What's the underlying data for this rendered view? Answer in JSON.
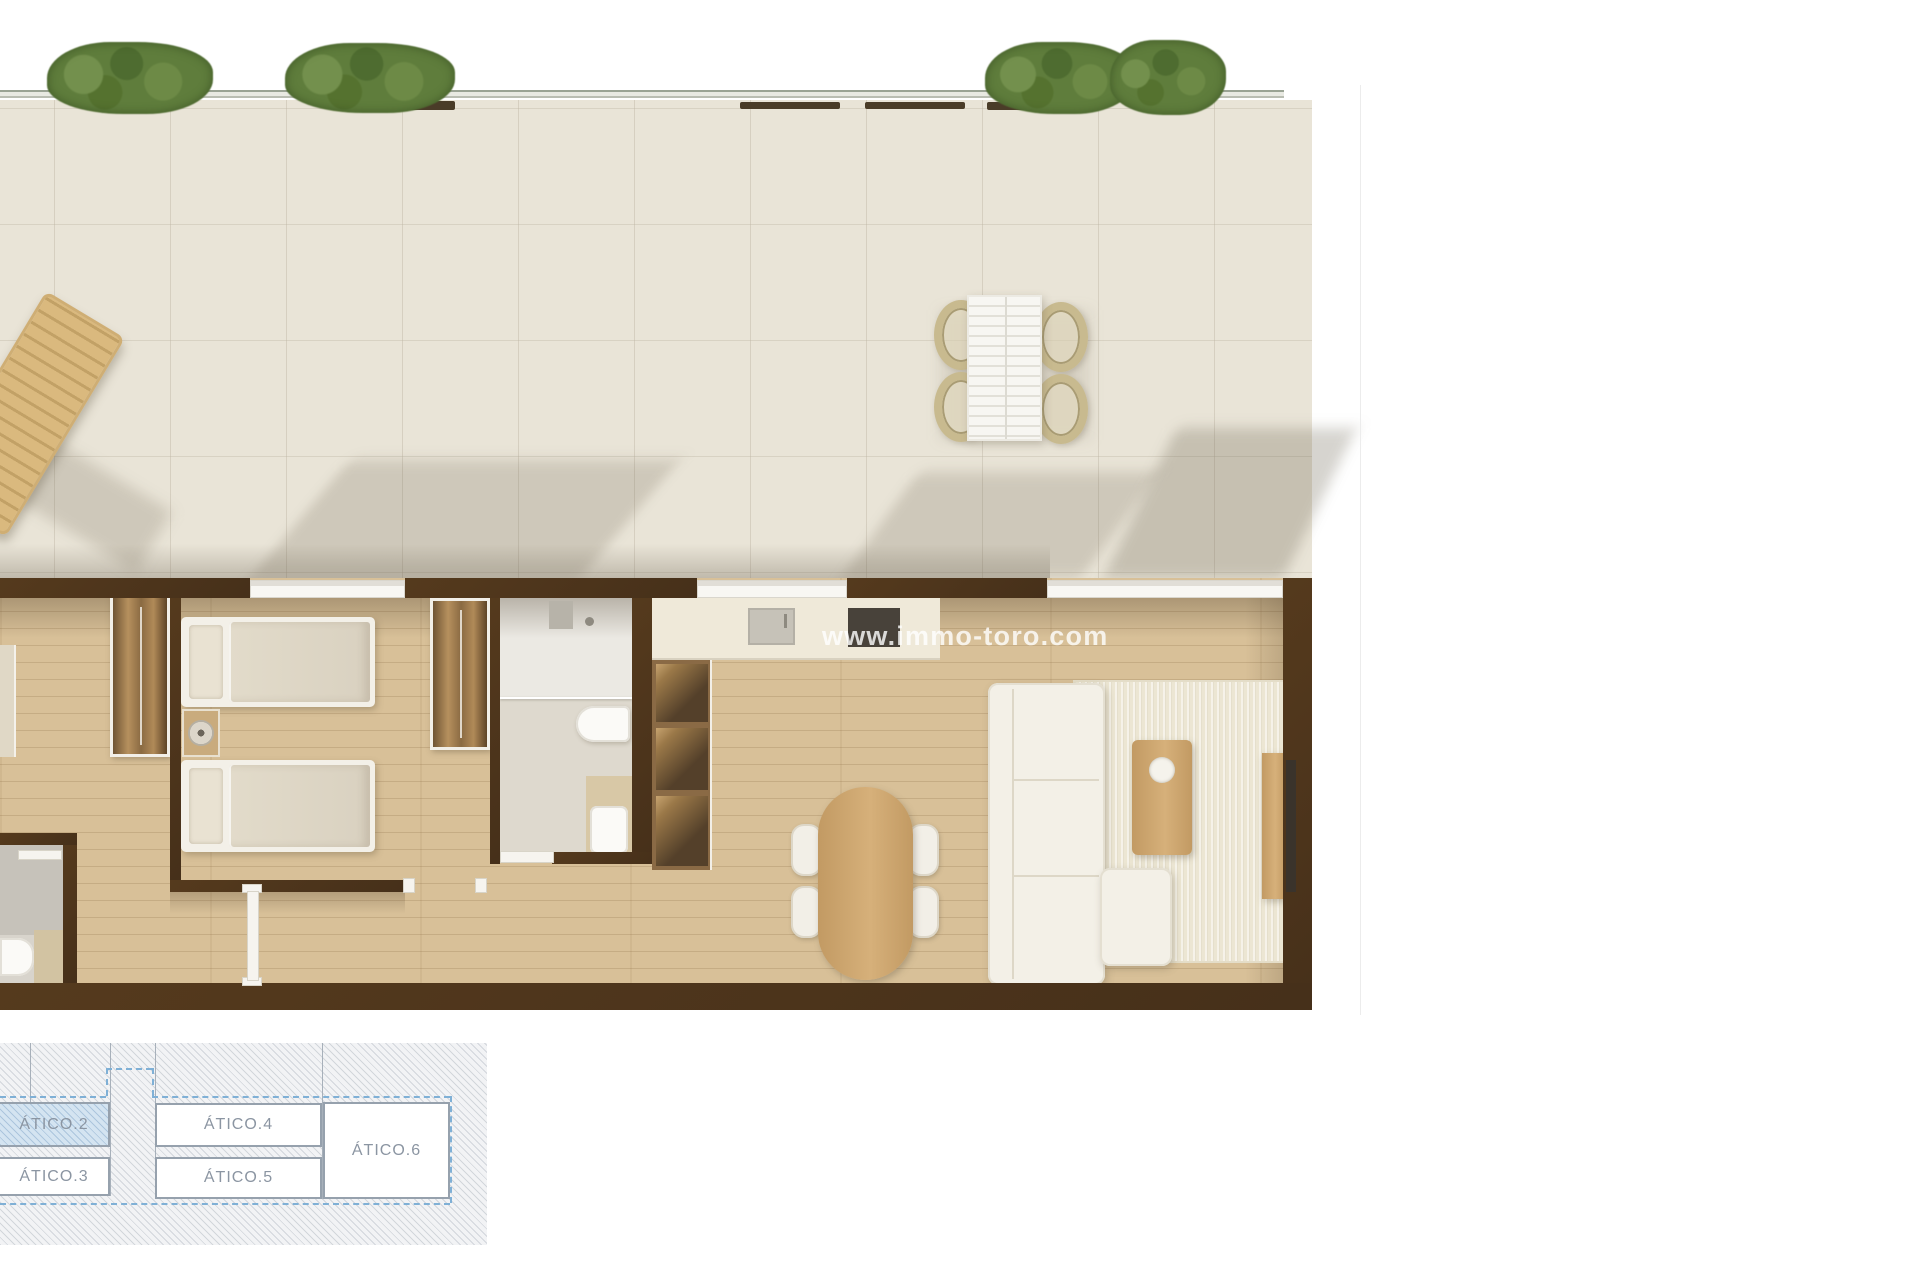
{
  "watermark": {
    "text": "www.immo-toro.com",
    "color": "#ffffff"
  },
  "keyplan": {
    "units": [
      {
        "label": "ÁTICO.2",
        "highlighted": true
      },
      {
        "label": "ÁTICO.3",
        "highlighted": false
      },
      {
        "label": "ÁTICO.4",
        "highlighted": false
      },
      {
        "label": "ÁTICO.5",
        "highlighted": false
      },
      {
        "label": "ÁTICO.6",
        "highlighted": false
      }
    ],
    "label_color": "#8b95a2",
    "highlight_fill": "#d4e4f1",
    "dash_color": "#7fb0d6"
  },
  "palette": {
    "wall": "#4d3419",
    "wood_floor": "#d8c098",
    "terrace_tile": "#e9e4d7",
    "hedge_green": "#5f7d3c",
    "rug": "#ece6d3",
    "sofa": "#f3f0e7"
  }
}
